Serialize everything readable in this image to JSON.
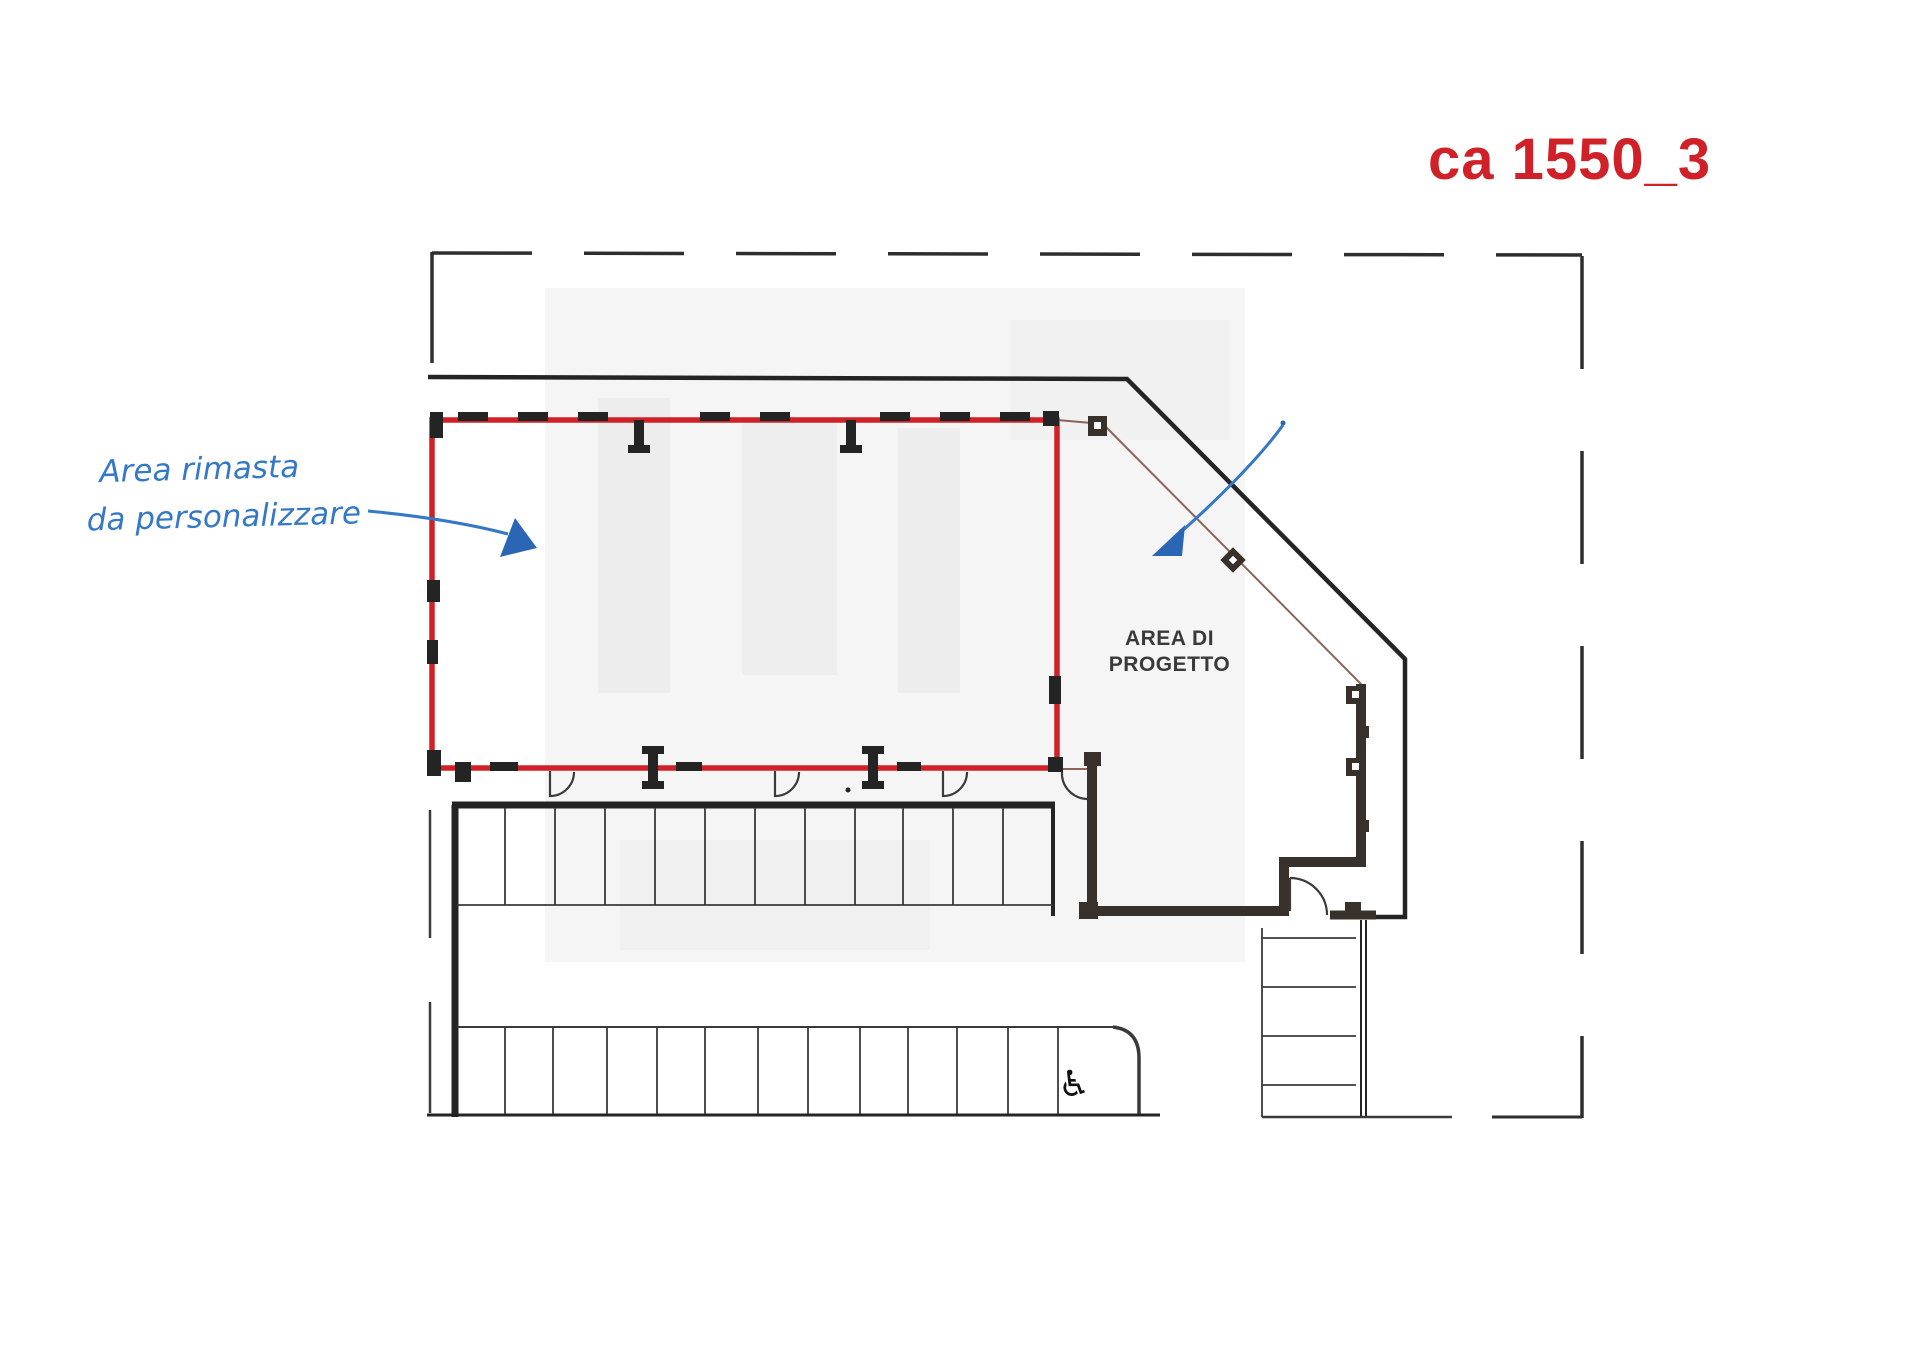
{
  "colors": {
    "paper": "#ffffff",
    "outline-red": "#cf2127",
    "note-blue": "#3578c6",
    "arrow-blue": "#2b66b4",
    "hatch-stripe": "#dd8e88",
    "hatch-bg": "#fcf1ef",
    "wall-dark": "#38302a",
    "line-dark": "#242424",
    "line-mid": "#3a3a3a",
    "label-gray": "#3a3a3a",
    "watermark-gray": "#f5f5f5"
  },
  "header": {
    "drawing_code": "ca 1550_3"
  },
  "annotations": {
    "note_line1": "Area rimasta",
    "note_line2": "da personalizzare"
  },
  "plan": {
    "area_label_line1": "AREA DI",
    "area_label_line2": "PROGETTO"
  },
  "icons": {
    "accessible_parking": "♿"
  }
}
